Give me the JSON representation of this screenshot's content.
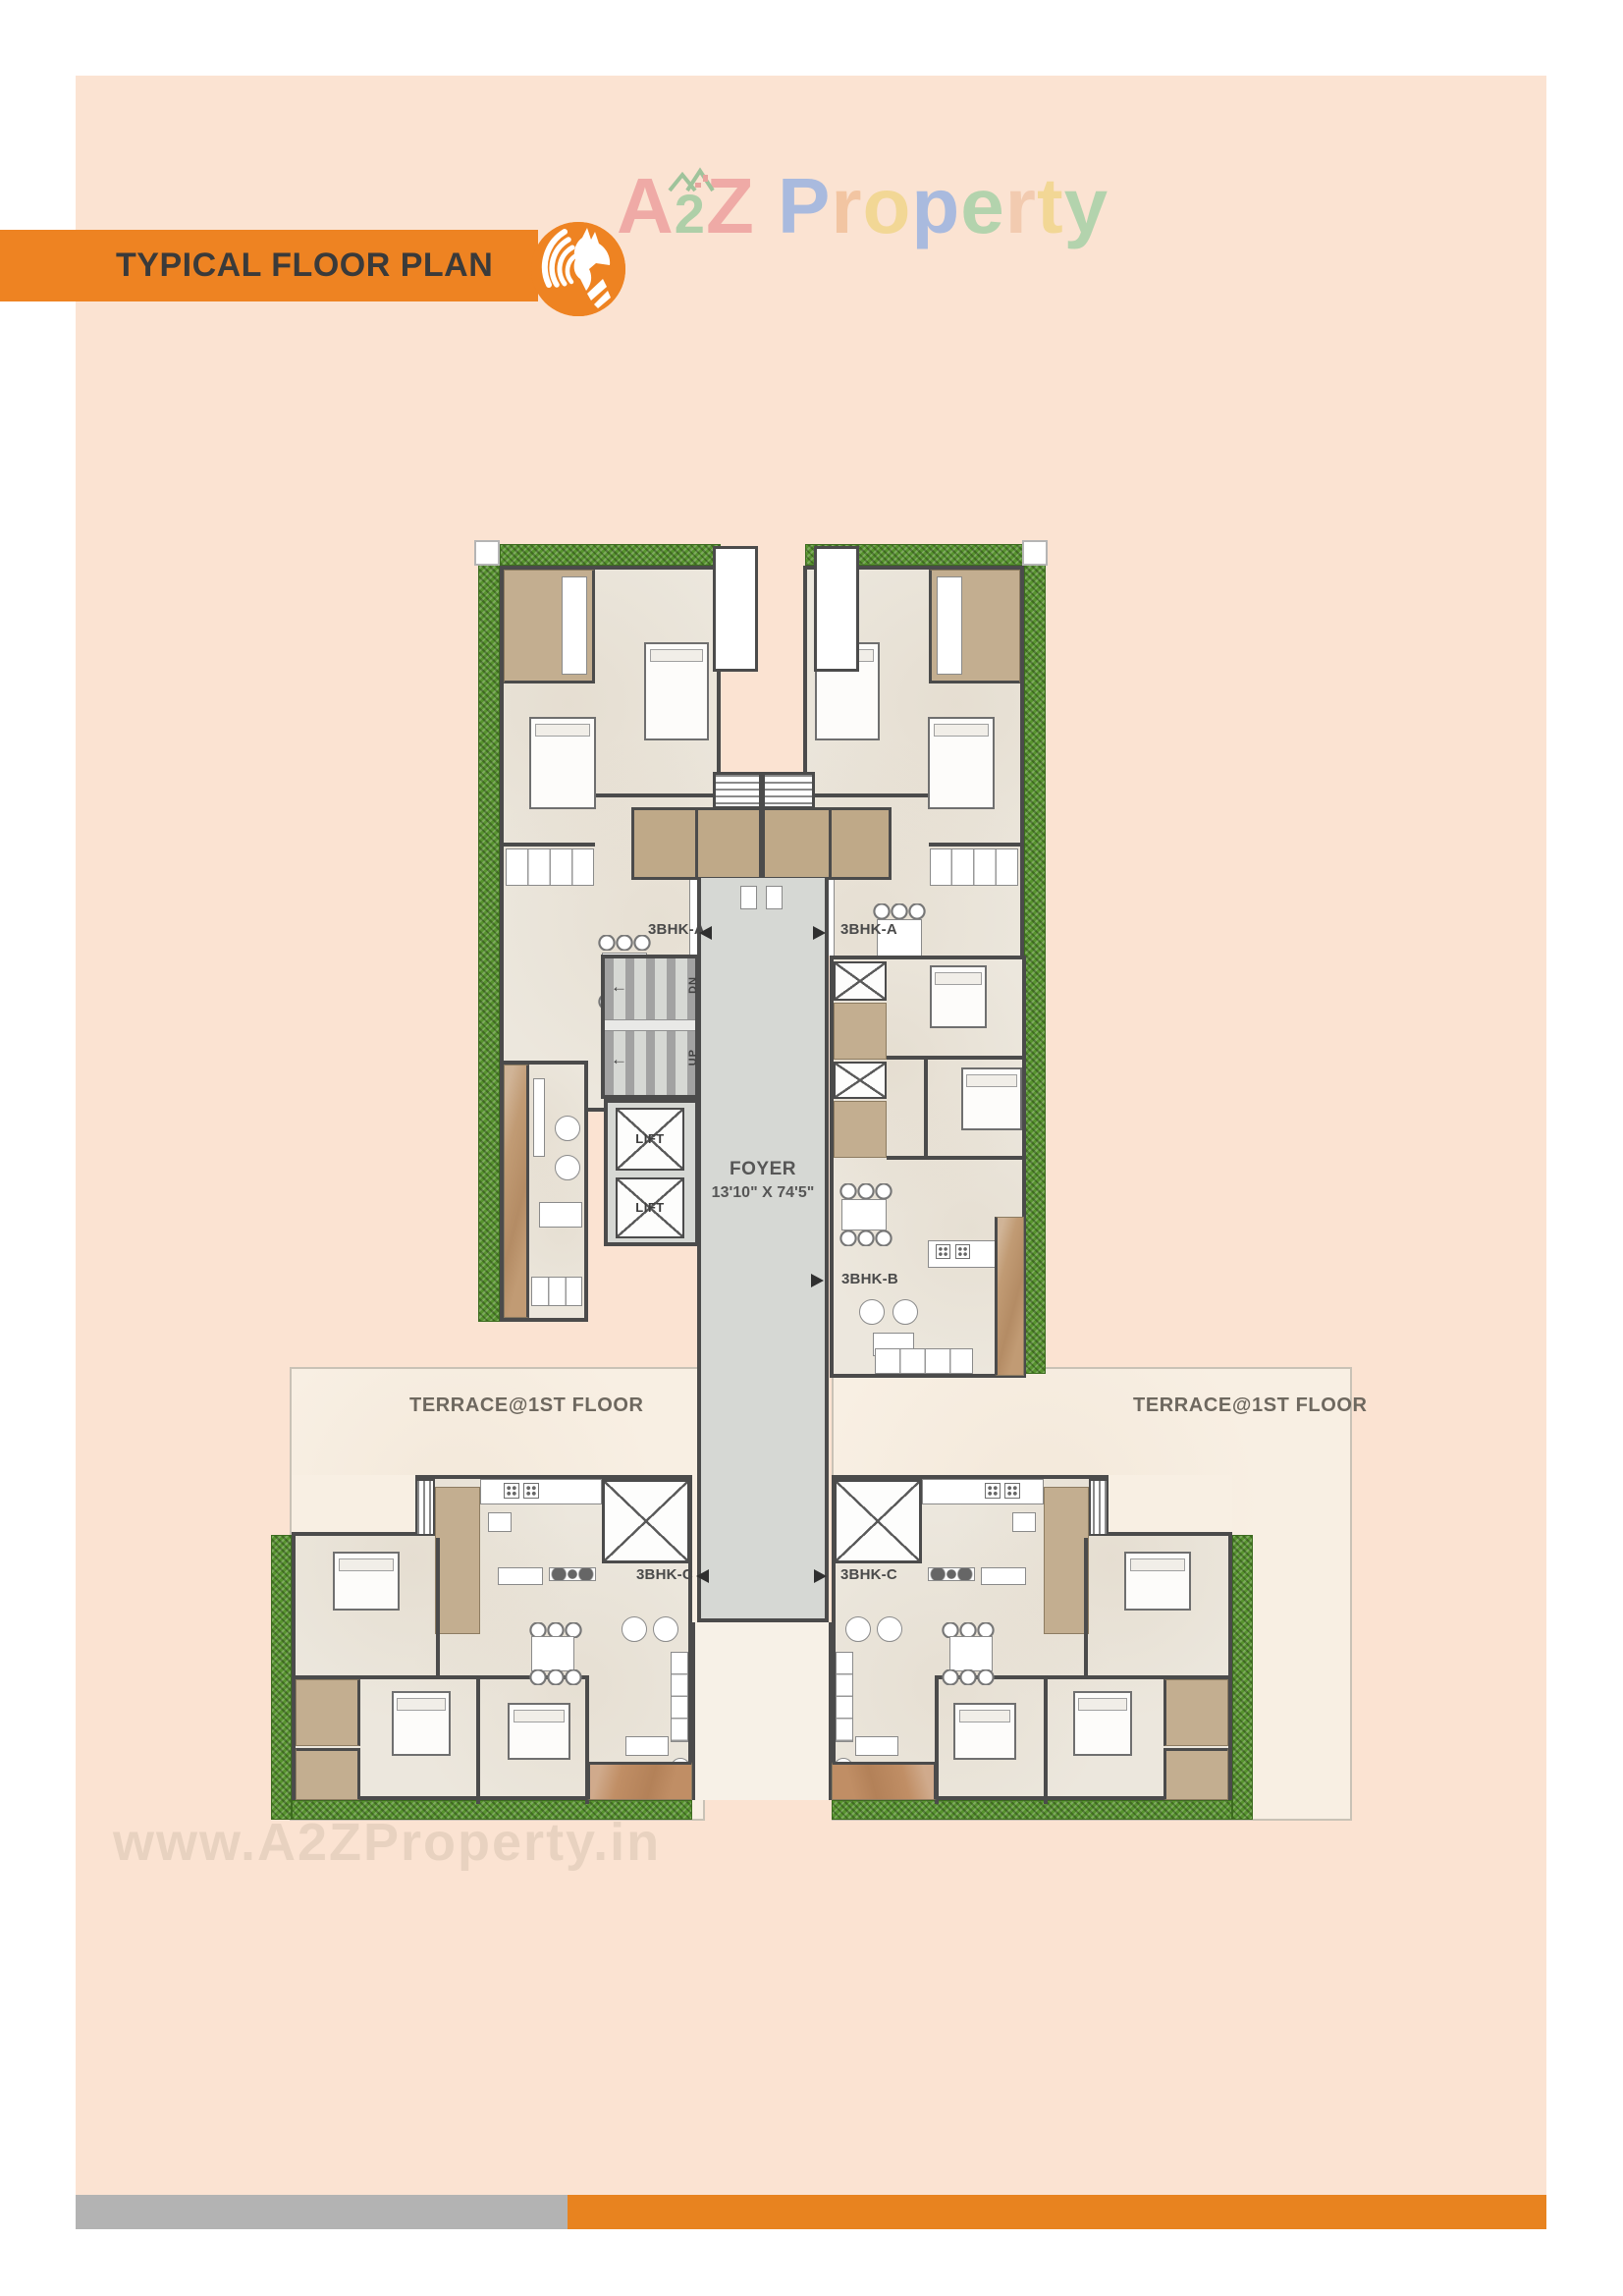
{
  "header": {
    "banner": {
      "title": "TYPICAL FLOOR PLAN",
      "color": "#ee8322",
      "text_color": "#3a3a3a"
    },
    "badge": {
      "icon": "horse-icon",
      "color": "#ee8322"
    },
    "logo": {
      "a2z": [
        {
          "char": "A",
          "color": "#efaaa6",
          "size": "large"
        },
        {
          "char": "2",
          "color": "#aecfa8",
          "size": "small"
        },
        {
          "char": "Z",
          "color": "#efaaa6",
          "size": "large"
        }
      ],
      "word": [
        {
          "char": "P",
          "color": "#a9bade"
        },
        {
          "char": "r",
          "color": "#f2c5a2"
        },
        {
          "char": "o",
          "color": "#f2d795"
        },
        {
          "char": "p",
          "color": "#a9bade"
        },
        {
          "char": "e",
          "color": "#b3d3ad"
        },
        {
          "char": "r",
          "color": "#f2cbb0"
        },
        {
          "char": "t",
          "color": "#f2d795"
        },
        {
          "char": "y",
          "color": "#b3d3ad"
        }
      ],
      "house_icon": "house-roof-icon"
    }
  },
  "floorplan": {
    "units": {
      "a_left": "3BHK-A",
      "a_right": "3BHK-A",
      "b": "3BHK-B",
      "c_left": "3BHK-C",
      "c_right": "3BHK-C"
    },
    "core": {
      "lift1": "LIFT",
      "lift2": "LIFT",
      "down": "DN",
      "up": "UP"
    },
    "foyer": {
      "name": "FOYER",
      "size": "13'10\" X 74'5\""
    },
    "terrace_left": "TERRACE@1ST FLOOR",
    "terrace_right": "TERRACE@1ST FLOOR",
    "colors": {
      "wall": "#4b4b4b",
      "room_floor": "#ece7dd",
      "core_gray": "#d6d8d4",
      "hedge_green": "#57942e",
      "tan": "#c3ae90",
      "terrace": "#f8efe3"
    }
  },
  "watermark": "www.A2ZProperty.in",
  "footer": {
    "gray": "#b3b3b3",
    "orange": "#e8831f"
  }
}
